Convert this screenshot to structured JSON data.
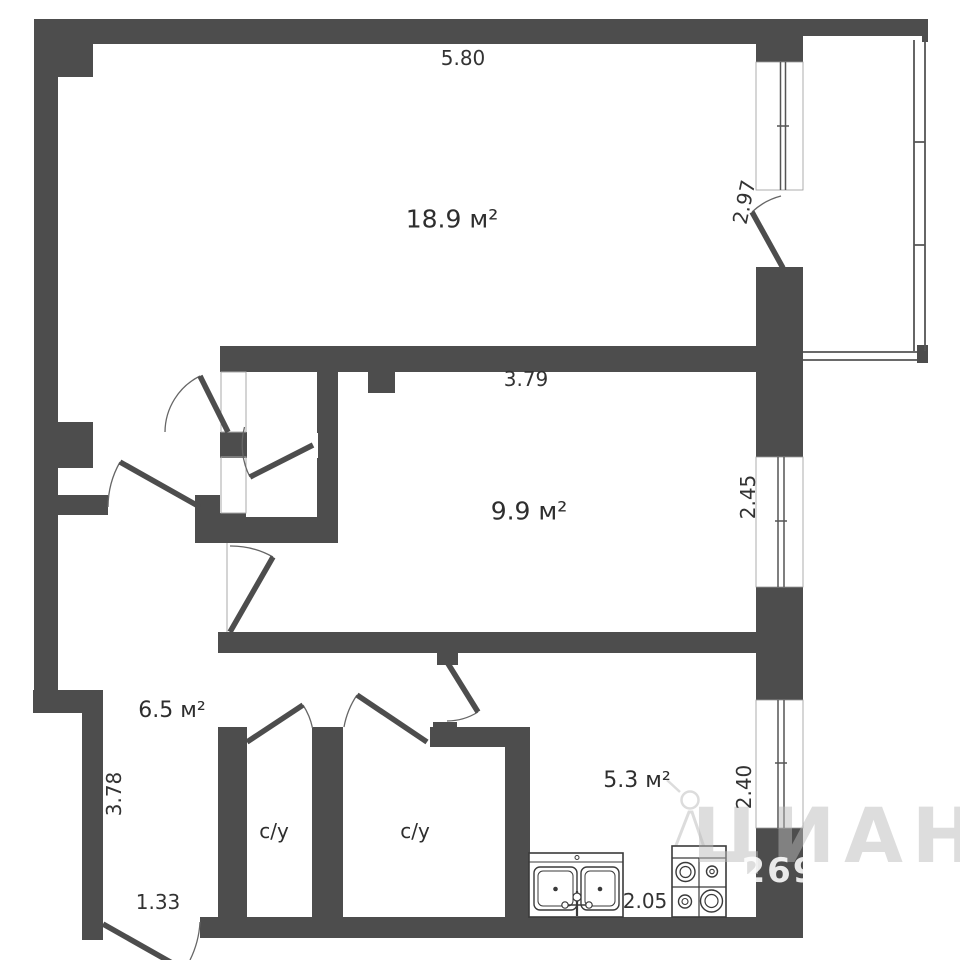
{
  "floorplan": {
    "rooms": {
      "living_room": {
        "area_label": "18.9 м²"
      },
      "bedroom": {
        "area_label": "9.9 м²"
      },
      "hallway": {
        "area_label": "6.5 м²"
      },
      "kitchen": {
        "area_label": "5.3 м²"
      },
      "bathroom_1": {
        "label": "с/у"
      },
      "bathroom_2": {
        "label": "с/у"
      }
    },
    "dimensions": {
      "living_top_width_m": "5.80",
      "living_right_height_m": "2.97",
      "bedroom_top_width_m": "3.79",
      "bedroom_window_height_m": "2.45",
      "hallway_left_height_m": "3.78",
      "entry_width_m": "1.33",
      "kitchen_bottom_width_m": "2.05",
      "kitchen_window_height_m": "2.40"
    },
    "fixtures": [
      "double-sink-icon",
      "stove-4-burner-icon"
    ],
    "watermark": {
      "brand": "ЦИАН",
      "number": "269"
    },
    "colors": {
      "wall": "#4d4d4d",
      "thin_line": "#555555",
      "door_arc": "#666666",
      "background": "#ffffff",
      "watermark_gray": "#bababa"
    }
  }
}
